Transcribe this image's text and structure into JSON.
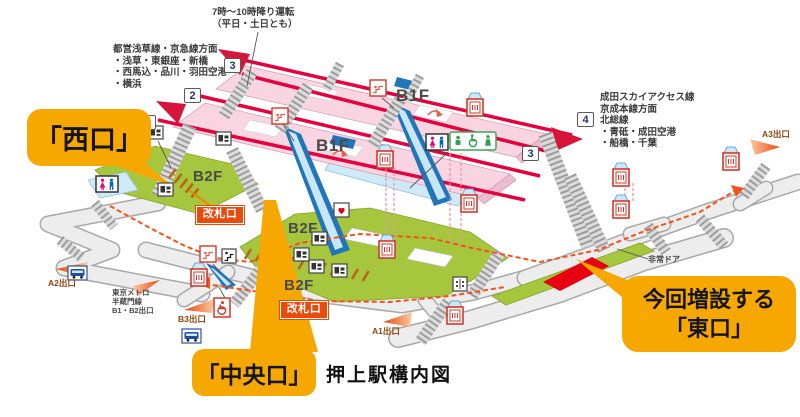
{
  "title": "押上駅構内図",
  "floors": {
    "b1f": "B1F",
    "b2f": "B2F"
  },
  "gates_label": "改札口",
  "callouts": {
    "west": "「西口」",
    "central": "「中央口」",
    "east": {
      "line1": "今回増設する",
      "line2": "「東口」"
    }
  },
  "notes": {
    "escalator": {
      "line1": "7時〜10時降り運転",
      "line2": "（平日・土日とも）"
    },
    "west_directions": {
      "line1": "都営浅草線・京急線方面",
      "line2": "・浅草・東銀座・新橋",
      "line3": "・西馬込・品川・羽田空港",
      "line4": "・横浜"
    },
    "east_directions": {
      "line1": "成田スカイアクセス線",
      "line2": "京成本線方面",
      "line3": "北総線",
      "line4": "・青砥・成田空港",
      "line5": "・船橋・千葉"
    },
    "emergency_door": "非常ドア"
  },
  "exits": {
    "a1": "A1出口",
    "a2": "A2出口",
    "a3": "A3出口",
    "b3": "B3出口",
    "metro": {
      "line1": "東京メトロ",
      "line2": "半蔵門線",
      "line3": "B1・B2出口"
    }
  },
  "platform_numbers": {
    "left_3": "3",
    "left_2": "2",
    "left_1": "1",
    "right_4": "4",
    "right_3": "3"
  },
  "colors": {
    "callout_orange": "#F6A800",
    "gate_red": "#EA4A0A",
    "track_red": "#E4003F",
    "platform_pink": "#F8D5E1",
    "concourse_green": "#A6C73D",
    "route_dash": "#F4511E",
    "escalator_blue": "#2176B9",
    "east_exit_red": "#E60012"
  }
}
